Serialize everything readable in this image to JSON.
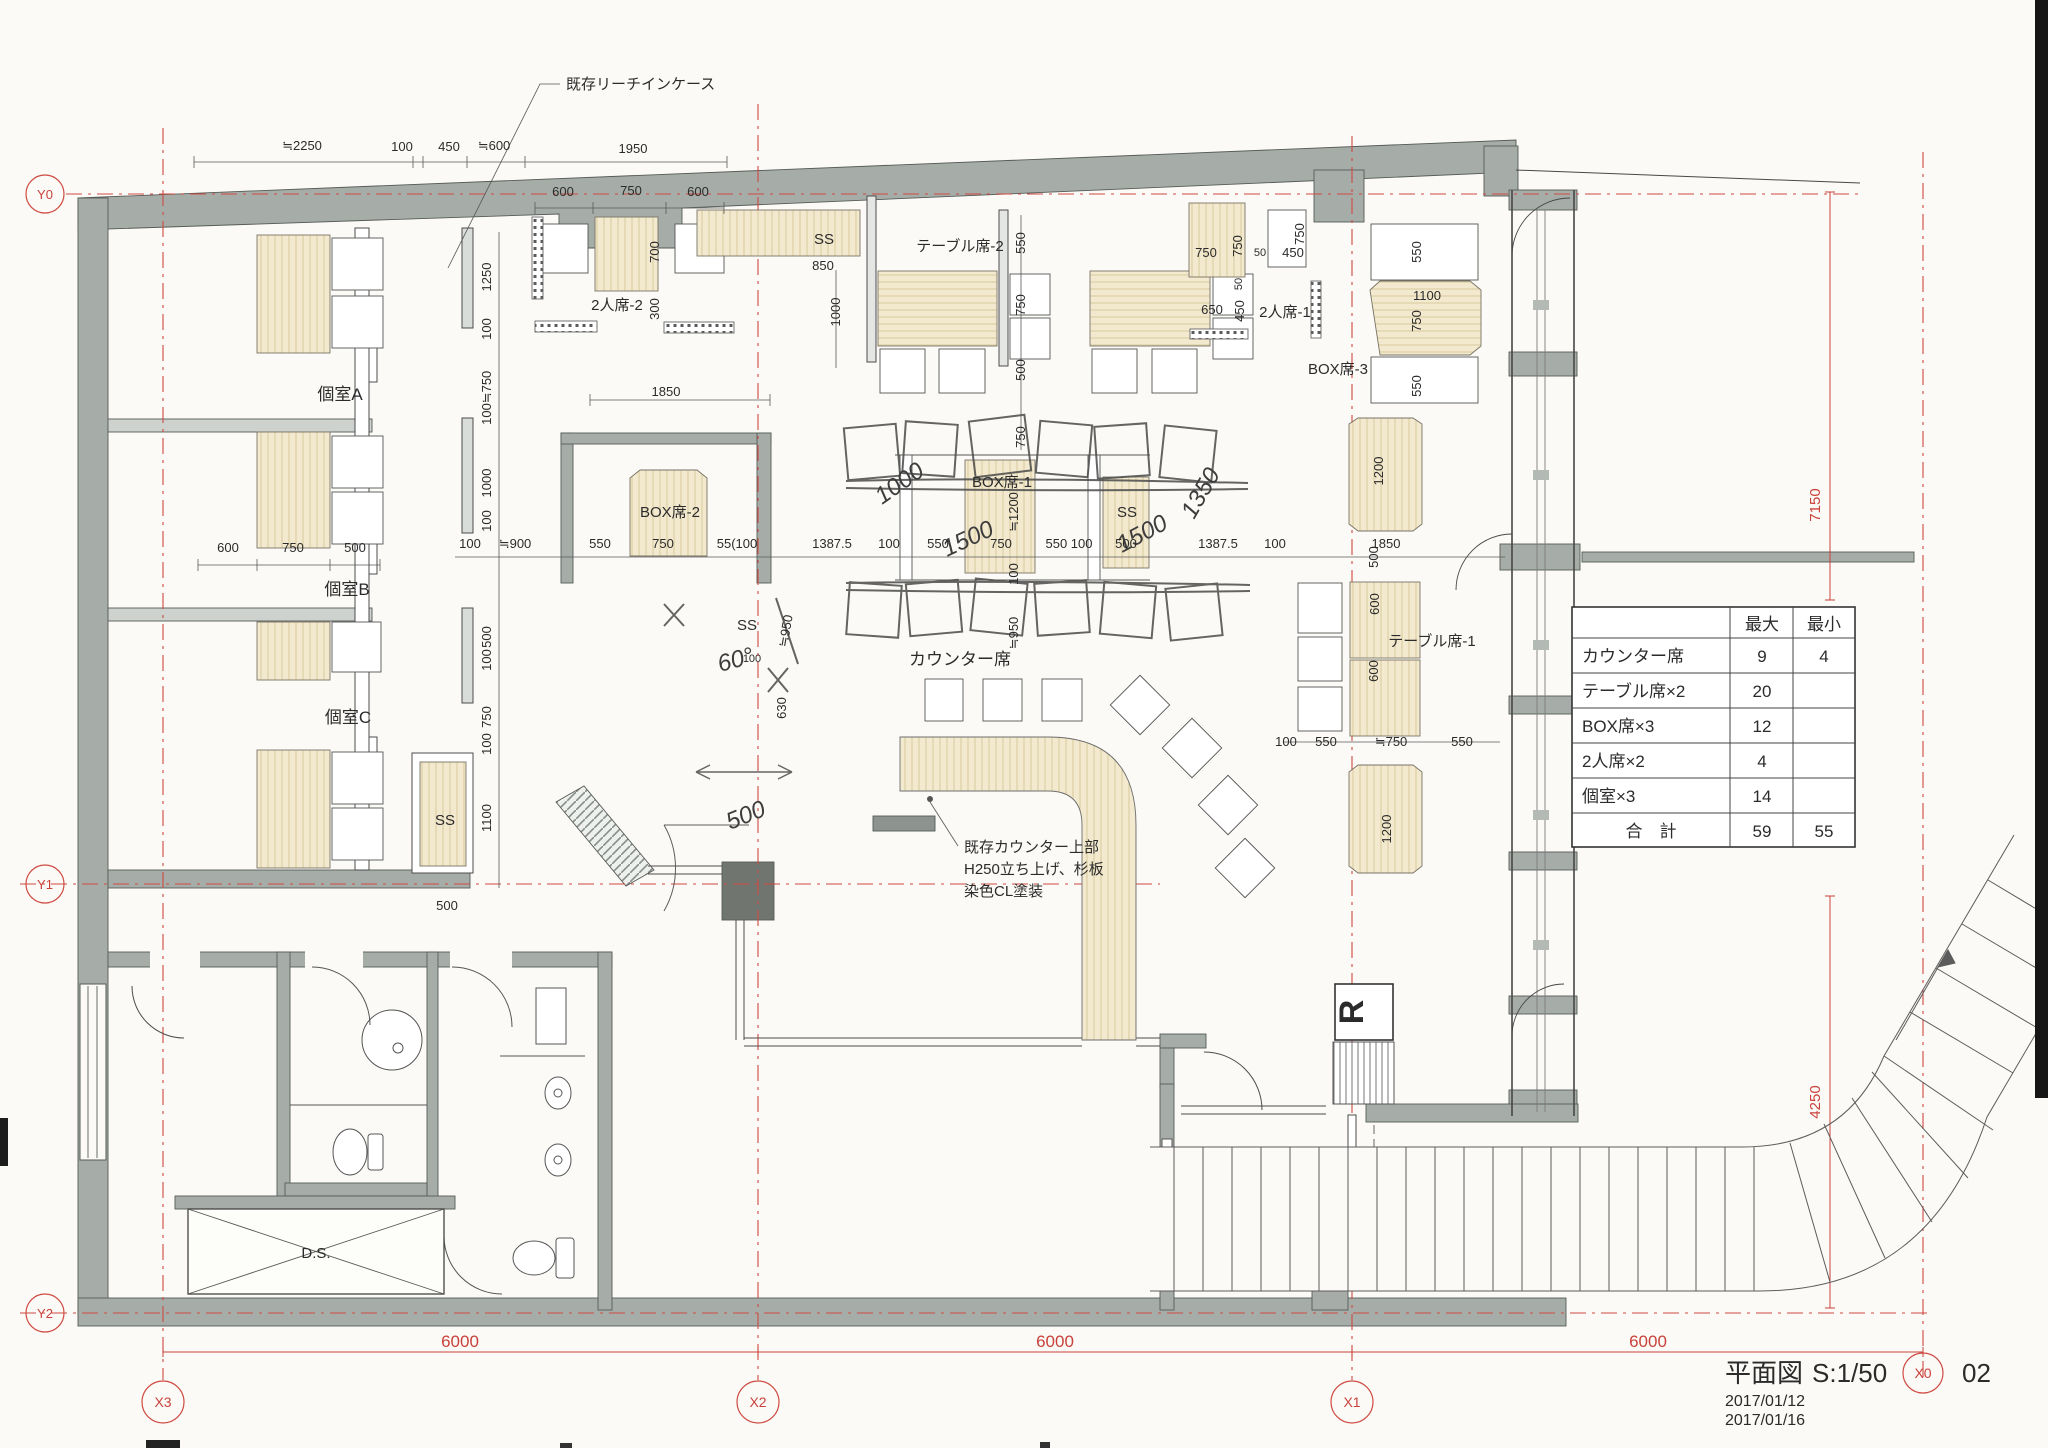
{
  "title_block": {
    "name": "平面図",
    "scale": "S:1/50",
    "sheet": "02",
    "date1": "2017/01/12",
    "date2": "2017/01/16"
  },
  "grid": {
    "x0": "X0",
    "x1": "X1",
    "x2": "X2",
    "x3": "X3",
    "y0": "Y0",
    "y1": "Y1",
    "y2": "Y2",
    "span_6000": "6000",
    "right_upper": "7150",
    "right_lower": "4250"
  },
  "capacity_table": {
    "header_max": "最大",
    "header_min": "最小",
    "rows": [
      {
        "label": "カウンター席",
        "max": "9",
        "min": "4"
      },
      {
        "label": "テーブル席×2",
        "max": "20",
        "min": ""
      },
      {
        "label": "BOX席×3",
        "max": "12",
        "min": ""
      },
      {
        "label": "2人席×2",
        "max": "4",
        "min": ""
      },
      {
        "label": "個室×3",
        "max": "14",
        "min": ""
      },
      {
        "label": "合　計",
        "max": "59",
        "min": "55"
      }
    ]
  },
  "rooms": {
    "private_a": "個室A",
    "private_b": "個室B",
    "private_c": "個室C",
    "box1": "BOX席-1",
    "box2": "BOX席-2",
    "box3": "BOX席-3",
    "table1": "テーブル席-1",
    "table2": "テーブル席-2",
    "pair1": "2人席-1",
    "pair2": "2人席-2",
    "counter": "カウンター席",
    "vestibule": "風除室",
    "ss": "SS",
    "ds": "D.S.",
    "dn": "DN",
    "r_mark": "R"
  },
  "annotations": {
    "reach_in_case": "既存リーチインケース",
    "counter_note_1": "既存カウンター上部",
    "counter_note_2": "H250立ち上げ、杉板",
    "counter_note_3": "染色CL塗装"
  },
  "dims": {
    "top_row1": [
      "≒2250",
      "100",
      "450",
      "≒600",
      "1950"
    ],
    "top_row2": [
      "600",
      "750",
      "600"
    ],
    "left_col": [
      "1250",
      "100",
      "≒750",
      "100",
      "1000",
      "100",
      "500",
      "100",
      "750",
      "100",
      "1100"
    ],
    "left_below": "500",
    "room_widths": [
      "600",
      "750",
      "500"
    ],
    "pair2_col": [
      "700",
      "300"
    ],
    "ss_top": [
      "850",
      "1000"
    ],
    "box2_width": "1850",
    "mid_chain": [
      "100",
      "≒900",
      "550",
      "750",
      "55(100",
      "1387.5",
      "100",
      "550",
      "750",
      "550 100",
      "500",
      "1387.5",
      "100",
      "1850"
    ],
    "table2_col": [
      "550",
      "750",
      "500",
      "750"
    ],
    "pair1_dims": [
      "750",
      "750",
      "50",
      "450",
      "750",
      "50",
      "650",
      "450"
    ],
    "box3_dims": [
      "550",
      "1100",
      "750",
      "550",
      "1200"
    ],
    "box1_col": [
      "≒1200",
      "100",
      "≒950"
    ],
    "corridor_dims": [
      "≒950",
      "100",
      "630"
    ],
    "table1_dims": [
      "500",
      "600",
      "600",
      "1200",
      "100",
      "550",
      "≒750",
      "550"
    ]
  },
  "handwritten": [
    "1000",
    "1500",
    "1500",
    "1350",
    "60°",
    "500"
  ]
}
